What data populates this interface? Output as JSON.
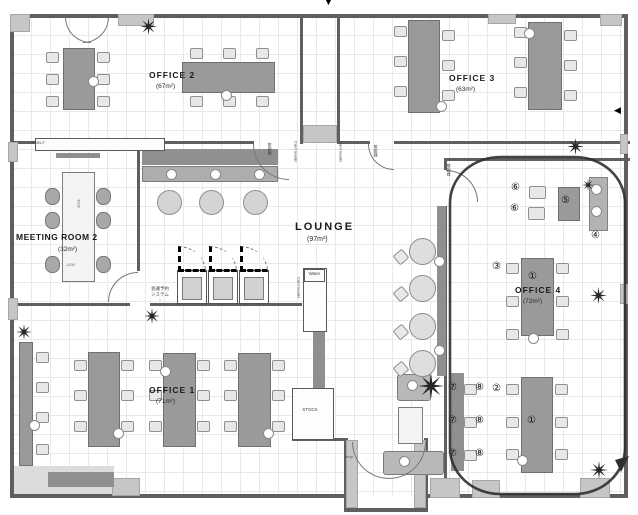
{
  "rooms": {
    "office2": {
      "name": "OFFICE 2",
      "area": "(67m²)"
    },
    "office3": {
      "name": "OFFICE 3",
      "area": "(63m²)"
    },
    "office1": {
      "name": "OFFICE 1",
      "area": "(71m²)"
    },
    "office4": {
      "name": "OFFICE 4",
      "area": "(72m²)"
    },
    "meeting_room2": {
      "name": "MEETING ROOM 2",
      "area": "(32m²)"
    },
    "lounge": {
      "name": "LOUNGE",
      "area": "(97m²)"
    }
  },
  "markers": {
    "m1": "①",
    "m2": "②",
    "m3": "③",
    "m4": "④",
    "m5": "⑤",
    "m6": "⑥",
    "m7": "⑦",
    "m8": "⑧"
  },
  "labels": {
    "water": "Water",
    "stock": "STOCK",
    "shelf": "SHELF",
    "card_reader": "Card reader",
    "alarm": "警報器",
    "reservation_line1": "会議予約",
    "reservation_line2": "システム",
    "dim_length": "4200",
    "dim_width": "1200",
    "drop": "drop",
    "arrow_down": "▼",
    "arrow_left": "◀",
    "arrow_small_down": "↓"
  },
  "colors": {
    "wall": "#5f5f5f",
    "desk": "#9a9a9a",
    "annotation": "#2f2f2f",
    "plant": "#262626"
  },
  "icons": {
    "plant": "plant-star"
  }
}
